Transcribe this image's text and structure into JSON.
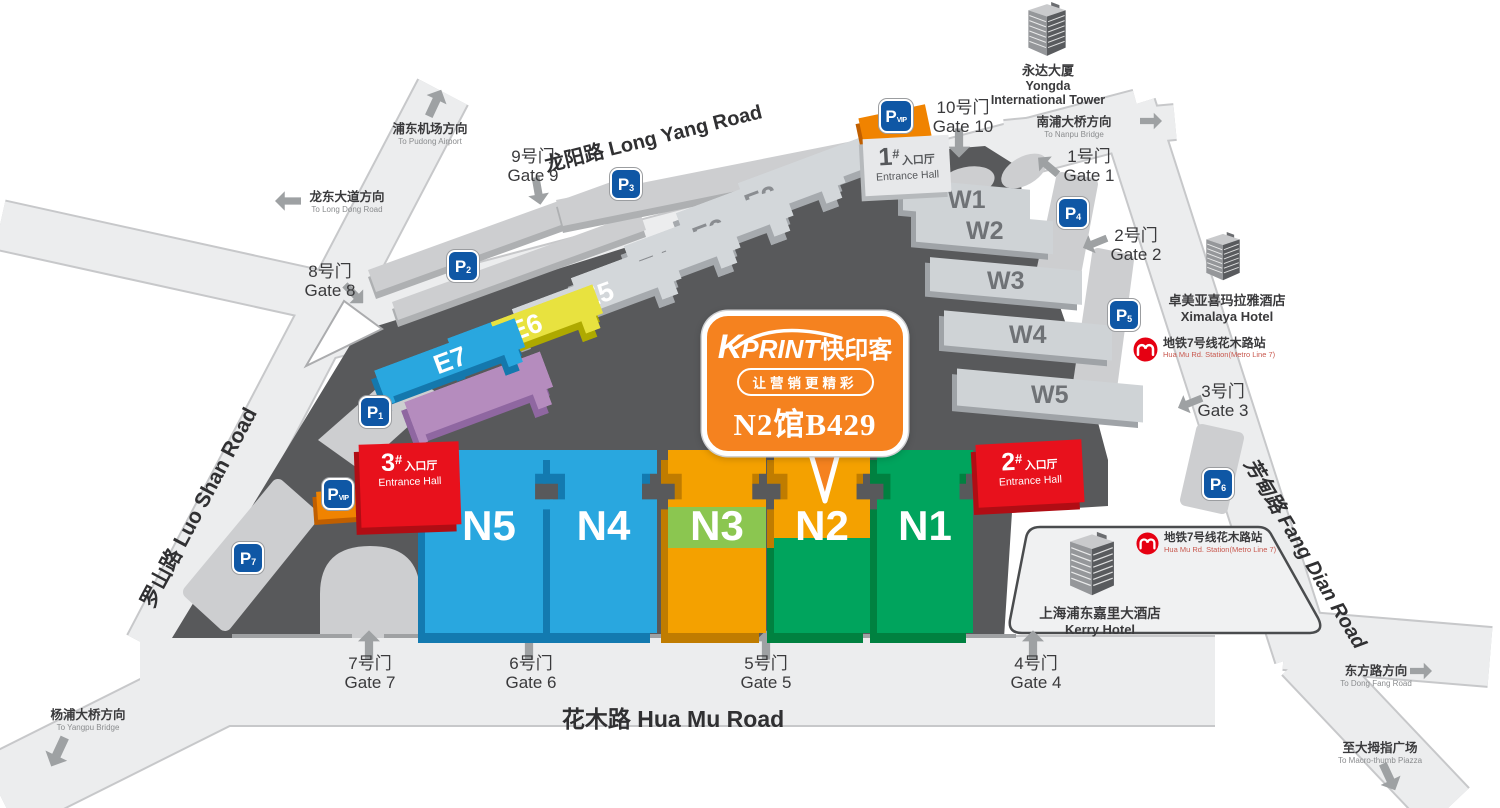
{
  "callout": {
    "brand_k": "K",
    "brand_print": "PRINT",
    "brand_cn": "快印客",
    "tagline": "让营销更精彩",
    "booth": "N2馆B429"
  },
  "roads": {
    "long_yang": "龙阳路 Long Yang Road",
    "hua_mu": "花木路 Hua Mu Road",
    "luo_shan": "罗山路 Luo Shan Road",
    "fang_dian": "芳甸路 Fang Dian Road"
  },
  "gates": [
    {
      "zh": "1号门",
      "en": "Gate 1"
    },
    {
      "zh": "2号门",
      "en": "Gate 2"
    },
    {
      "zh": "3号门",
      "en": "Gate 3"
    },
    {
      "zh": "4号门",
      "en": "Gate 4"
    },
    {
      "zh": "5号门",
      "en": "Gate 5"
    },
    {
      "zh": "6号门",
      "en": "Gate 6"
    },
    {
      "zh": "7号门",
      "en": "Gate 7"
    },
    {
      "zh": "8号门",
      "en": "Gate 8"
    },
    {
      "zh": "9号门",
      "en": "Gate 9"
    },
    {
      "zh": "10号门",
      "en": "Gate 10"
    }
  ],
  "directions": {
    "pudong": {
      "zh": "浦东机场方向",
      "en": "To Pudong Airport"
    },
    "longdong": {
      "zh": "龙东大道方向",
      "en": "To Long Dong Road"
    },
    "nanpu": {
      "zh": "南浦大桥方向",
      "en": "To Nanpu Bridge"
    },
    "dongfang": {
      "zh": "东方路方向",
      "en": "To Dong Fang Road"
    },
    "macrothumb": {
      "zh": "至大拇指广场",
      "en": "To Macro-thumb Piazza"
    },
    "yangpu": {
      "zh": "杨浦大桥方向",
      "en": "To Yangpu Bridge"
    }
  },
  "halls": {
    "e": [
      "E1",
      "E2",
      "E3",
      "E4",
      "E5",
      "E6",
      "E7"
    ],
    "w": [
      "W1",
      "W2",
      "W3",
      "W4",
      "W5"
    ],
    "n": [
      "N1",
      "N2",
      "N3",
      "N4",
      "N5"
    ]
  },
  "entrances": [
    {
      "num": "1",
      "hash": "#",
      "zh": "入口厅",
      "en": "Entrance Hall"
    },
    {
      "num": "2",
      "hash": "#",
      "zh": "入口厅",
      "en": "Entrance Hall"
    },
    {
      "num": "3",
      "hash": "#",
      "zh": "入口厅",
      "en": "Entrance Hall"
    }
  ],
  "parking": {
    "letter": "P",
    "spots": [
      "1",
      "2",
      "3",
      "4",
      "5",
      "6",
      "7"
    ],
    "vip": "VIP"
  },
  "landmarks": {
    "yongda": {
      "zh": "永达大厦",
      "en1": "Yongda",
      "en2": "International Tower"
    },
    "ximalaya": {
      "zh": "卓美亚喜玛拉雅酒店",
      "en": "Ximalaya Hotel"
    },
    "kerry": {
      "zh": "上海浦东嘉里大酒店",
      "en": "Kerry Hotel"
    }
  },
  "metro": {
    "zh": "地铁7号线花木路站",
    "en": "Hua Mu Rd. Station(Metro Line 7)"
  },
  "colors": {
    "brand_orange": "#F5821F",
    "hall_blue": "#29A7DF",
    "hall_green": "#00A45D",
    "hall_orange": "#F4A100",
    "hall_yellow": "#E8E23F",
    "hall_purple": "#B58CBE",
    "entrance_red": "#E8111C",
    "parking_blue": "#0F57A5",
    "metro_red": "#E60012",
    "map_dark": "#58595B"
  }
}
